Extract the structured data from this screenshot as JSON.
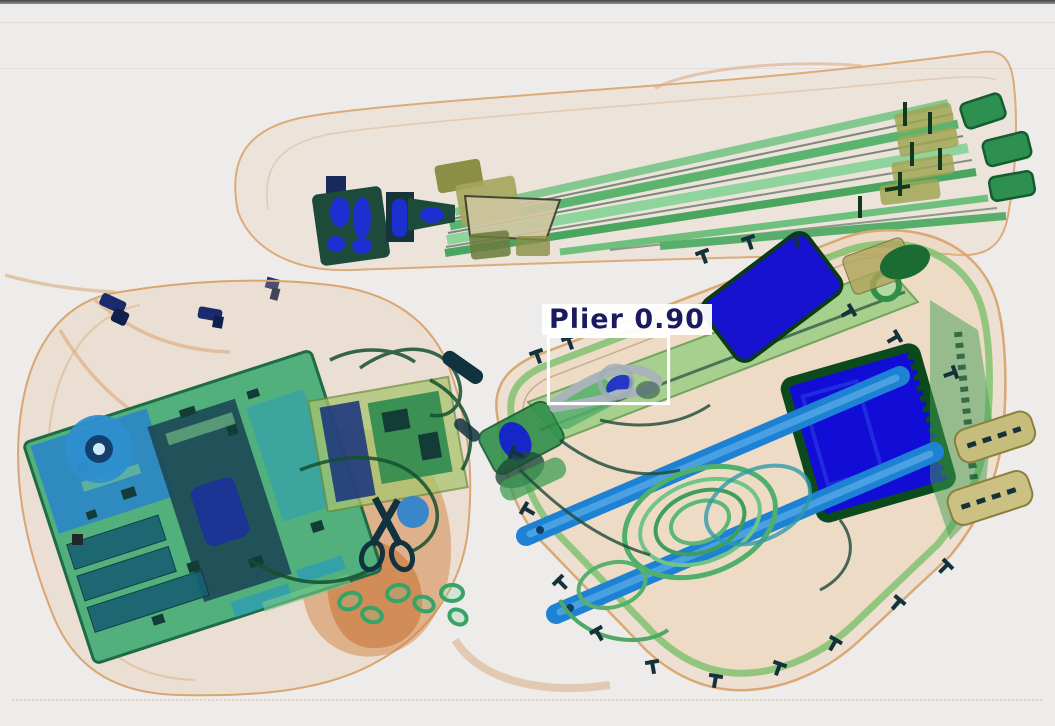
{
  "scene": {
    "type": "x-ray baggage scan",
    "background_color": "#edecea",
    "objects": {
      "top": "tripod-bag",
      "left": "backpack-with-electronics",
      "right": "hard-tool-case"
    },
    "palette": {
      "organic_tan": "#d9a673",
      "metal_green": "#5ab46e",
      "dense_blue": "#1712cf",
      "bright_blue": "#1e82d4"
    }
  },
  "detection": {
    "label": "Plier",
    "score": "0.90",
    "display": "Plier 0.90",
    "box_color": "#ffffff",
    "label_background": "#ffffff",
    "text_color": "#1a1b5f"
  }
}
